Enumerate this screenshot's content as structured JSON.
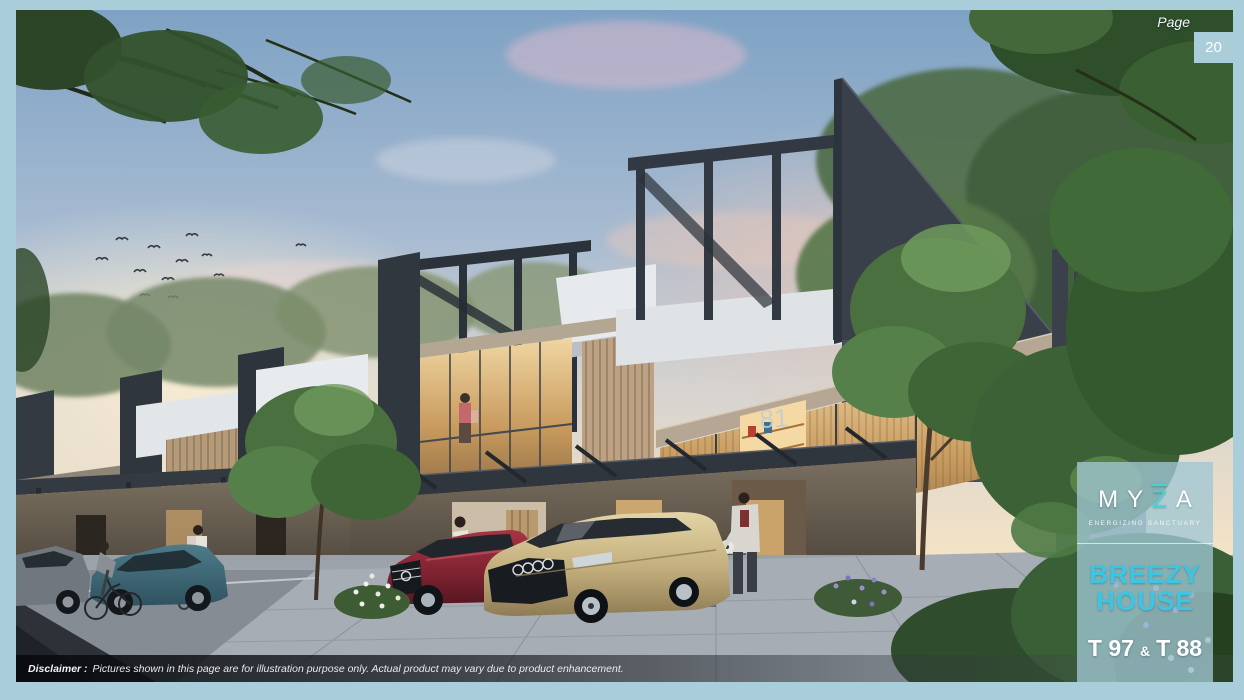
{
  "page": {
    "label": "Page",
    "number": "20"
  },
  "brand": {
    "letters": [
      "M",
      "Y",
      "Z",
      "A"
    ],
    "tagline": "ENERGIZING SANCTUARY"
  },
  "product": {
    "line1": "BREEZY",
    "line2": "HOUSE",
    "type_left": "T 97",
    "type_amp": "&",
    "type_right": "T 88"
  },
  "scene": {
    "house_number_main": "81",
    "house_number_neighbor": "83"
  },
  "disclaimer": {
    "label": "Disclaimer :",
    "text": "Pictures shown in this page are for illustration purpose only. Actual product may vary due to product enhancement."
  },
  "colors": {
    "frame": "#a9ced9",
    "accent_cyan": "#3cc5e5",
    "logo_accent": "#3fd8d8",
    "panel_overlay": "rgba(160,199,212,0.78)",
    "charcoal_structure": "#363c44",
    "warm_window": "#e5be7e",
    "red_car": "#8e2330",
    "gold_car": "#c6b286",
    "teal_car": "#3e6a78"
  }
}
